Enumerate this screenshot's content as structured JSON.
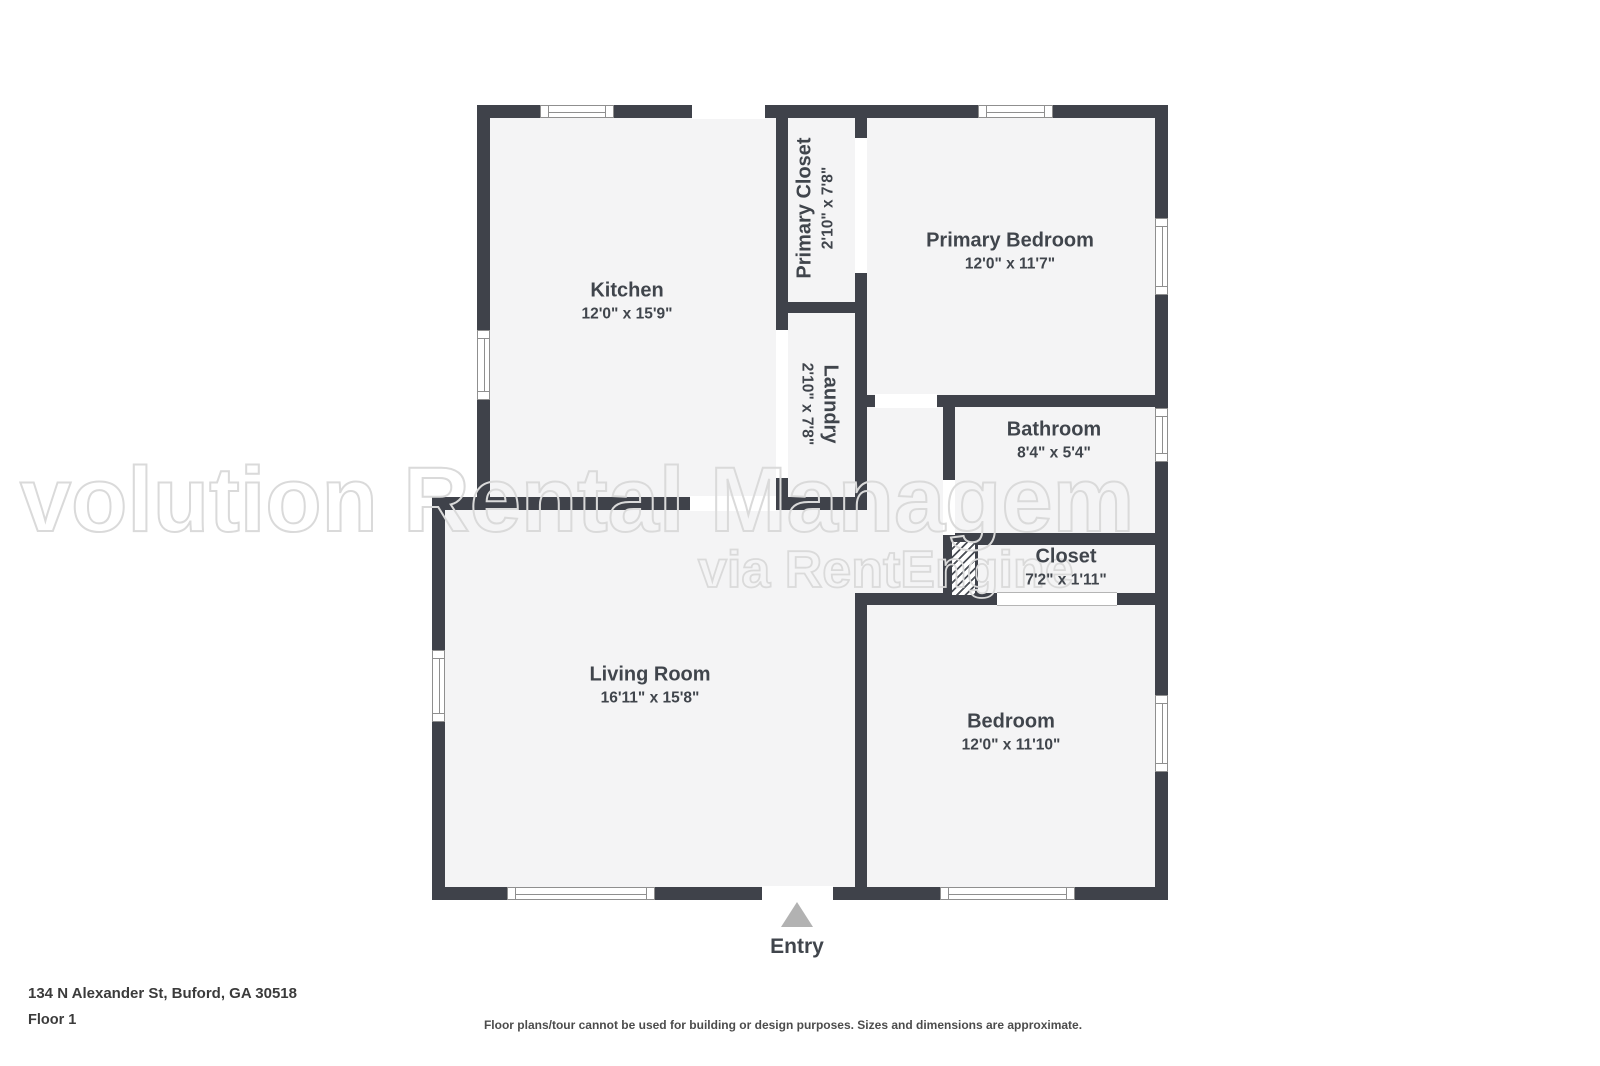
{
  "address_line": "134 N Alexander St, Buford, GA 30518",
  "floor_label": "Floor 1",
  "disclaimer": "Floor plans/tour cannot be used for building or design purposes. Sizes and dimensions are approximate.",
  "entry_label": "Entry",
  "watermark": {
    "line1": "volution Rental Managem",
    "line2": "via RentEngine"
  },
  "colors": {
    "wall": "#3f424a",
    "floor": "#f4f4f5",
    "label_text": "#40454c",
    "watermark_outline": "#dadada",
    "entry_arrow": "#b2b2b2"
  },
  "rooms": [
    {
      "name": "Kitchen",
      "dims": "12'0\" x 15'9\""
    },
    {
      "name": "Primary Closet",
      "dims": "2'10\" x 7'8\""
    },
    {
      "name": "Laundry",
      "dims": "2'10\" x 7'8\""
    },
    {
      "name": "Primary Bedroom",
      "dims": "12'0\" x 11'7\""
    },
    {
      "name": "Bathroom",
      "dims": "8'4\" x 5'4\""
    },
    {
      "name": "Closet",
      "dims": "7'2\" x 1'11\""
    },
    {
      "name": "Living Room",
      "dims": "16'11\" x 15'8\""
    },
    {
      "name": "Bedroom",
      "dims": "12'0\" x 11'10\""
    }
  ]
}
